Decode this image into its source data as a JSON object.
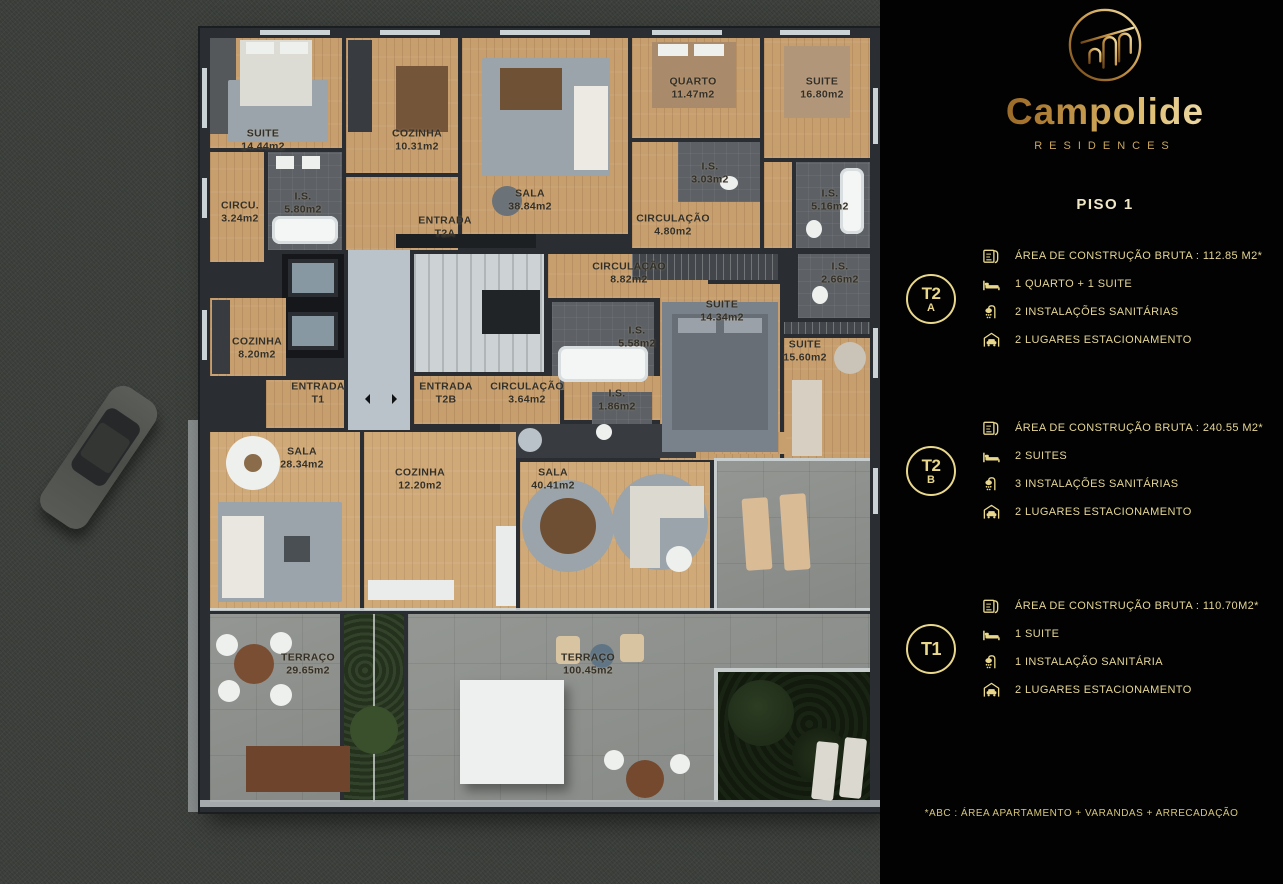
{
  "brand": {
    "name": "Campolide",
    "tagline": "RESIDENCES"
  },
  "floor_label": "PISO 1",
  "units": [
    {
      "badge_line1": "T2",
      "badge_line2": "A",
      "specs": [
        {
          "icon": "blueprint-icon",
          "text": "ÁREA DE CONSTRUÇÃO BRUTA :  112.85 M2*"
        },
        {
          "icon": "bed-icon",
          "text": "1 QUARTO + 1 SUITE"
        },
        {
          "icon": "shower-icon",
          "text": "2 INSTALAÇÕES SANITÁRIAS"
        },
        {
          "icon": "garage-car-icon",
          "text": "2 LUGARES ESTACIONAMENTO"
        }
      ]
    },
    {
      "badge_line1": "T2",
      "badge_line2": "B",
      "specs": [
        {
          "icon": "blueprint-icon",
          "text": "ÁREA DE CONSTRUÇÃO BRUTA :  240.55 M2*"
        },
        {
          "icon": "bed-icon",
          "text": "2 SUITES"
        },
        {
          "icon": "shower-icon",
          "text": "3 INSTALAÇÕES SANITÁRIAS"
        },
        {
          "icon": "garage-car-icon",
          "text": "2 LUGARES ESTACIONAMENTO"
        }
      ]
    },
    {
      "badge_line1": "T1",
      "badge_line2": "",
      "specs": [
        {
          "icon": "blueprint-icon",
          "text": "ÁREA DE CONSTRUÇÃO BRUTA :  110.70M2*"
        },
        {
          "icon": "bed-icon",
          "text": "1 SUITE"
        },
        {
          "icon": "shower-icon",
          "text": "1 INSTALAÇÃO SANITÁRIA"
        },
        {
          "icon": "garage-car-icon",
          "text": "2 LUGARES ESTACIONAMENTO"
        }
      ]
    }
  ],
  "footnote": "*ABC :  ÁREA APARTAMENTO + VARANDAS + ARRECADAÇÃO",
  "plan": {
    "labels": [
      {
        "name": "SUITE",
        "area": "14.44m2"
      },
      {
        "name": "COZINHA",
        "area": "10.31m2"
      },
      {
        "name": "SALA",
        "area": "38.84m2"
      },
      {
        "name": "QUARTO",
        "area": "11.47m2"
      },
      {
        "name": "SUITE",
        "area": "16.80m2"
      },
      {
        "name": "CIRCU.",
        "area": "3.24m2"
      },
      {
        "name": "I.S.",
        "area": "5.80m2"
      },
      {
        "name": "ENTRADA",
        "area": "T2A"
      },
      {
        "name": "CIRCULAÇÃO",
        "area": "4.80m2"
      },
      {
        "name": "I.S.",
        "area": "3.03m2"
      },
      {
        "name": "I.S.",
        "area": "5.16m2"
      },
      {
        "name": "CIRCULAÇÃO",
        "area": "8.82m2"
      },
      {
        "name": "I.S.",
        "area": "2.66m2"
      },
      {
        "name": "SUITE",
        "area": "14.34m2"
      },
      {
        "name": "I.S.",
        "area": "5.58m2"
      },
      {
        "name": "SUITE",
        "area": "15.60m2"
      },
      {
        "name": "COZINHA",
        "area": "8.20m2"
      },
      {
        "name": "ENTRADA",
        "area": "T1"
      },
      {
        "name": "ENTRADA",
        "area": "T2B"
      },
      {
        "name": "CIRCULAÇÃO",
        "area": "3.64m2"
      },
      {
        "name": "I.S.",
        "area": "1.86m2"
      },
      {
        "name": "SALA",
        "area": "28.34m2"
      },
      {
        "name": "COZINHA",
        "area": "12.20m2"
      },
      {
        "name": "SALA",
        "area": "40.41m2"
      },
      {
        "name": "TERRAÇO",
        "area": "29.65m2"
      },
      {
        "name": "TERRAÇO",
        "area": "100.45m2"
      }
    ]
  },
  "colors": {
    "accent_gold": "#e9d88b",
    "panel_bg": "#020202",
    "wood": "#c79e6d",
    "stone": "#8e918d"
  }
}
